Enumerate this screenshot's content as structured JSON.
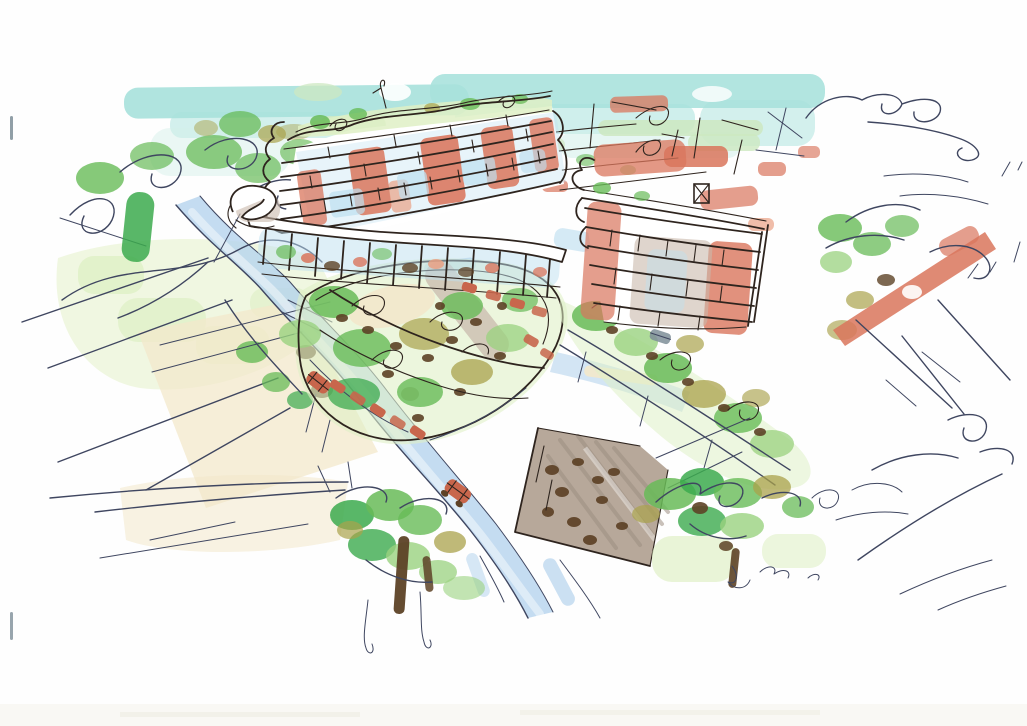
{
  "artwork": {
    "kind": "hand-drawn architectural concept sketch",
    "medium": "ink pen with marker and watercolor washes",
    "view": "aerial perspective of a mixed-use development",
    "visible_text": "",
    "description": "Aerial marker sketch of two curved terracotta apartment blocks over a retail podium, with a landscaped central garden with parked cars, light-blue access roads, a grey sloped plaza, street trees and a cyan sky band on white paper"
  },
  "palette": {
    "paper": "#fefefe",
    "sky": "#a7e1dc",
    "sky-light": "#d2efe9",
    "distant-green": "#cde8c1",
    "terracotta": "#d9755c",
    "terracotta-soft": "#e9a184",
    "glass": "#bedff0",
    "road": "#b5d3ed",
    "road-deep": "#8fb4da",
    "lawn": "#dff0c6",
    "lawn-pale": "#ecf5da",
    "green": "#68bb58",
    "green-bright": "#3caa4e",
    "green-soft": "#9ad27f",
    "olive": "#a9a24b",
    "olive-dark": "#8a7a30",
    "trunk": "#5d4226",
    "plaza": "#b7a89a",
    "plaza-dark": "#9d8e81",
    "concrete": "#c9b9ac",
    "cream": "#f3e8cb",
    "pen-dark": "#2e241e",
    "pen-blue": "#3f4660",
    "car-red": "#c8664c",
    "mark": "#7e8e98"
  },
  "scene": {
    "elements": [
      {
        "name": "sky-wash",
        "color": "sky"
      },
      {
        "name": "distant-buildings",
        "color": "terracotta"
      },
      {
        "name": "main-building",
        "color": "terracotta"
      },
      {
        "name": "east-building",
        "color": "terracotta"
      },
      {
        "name": "retail-podium",
        "color": "glass"
      },
      {
        "name": "spiral-ramp",
        "color": "concrete"
      },
      {
        "name": "access-road",
        "color": "road"
      },
      {
        "name": "central-garden-parking",
        "color": "green"
      },
      {
        "name": "right-garden-walk",
        "color": "green"
      },
      {
        "name": "gray-sloped-plaza",
        "color": "plaza"
      },
      {
        "name": "left-tree-cluster",
        "color": "green"
      },
      {
        "name": "bottom-tree-cluster",
        "color": "green-bright"
      },
      {
        "name": "bottom-right-tree-cluster",
        "color": "green"
      },
      {
        "name": "red-cars",
        "color": "car-red"
      },
      {
        "name": "scan-edge-marks",
        "color": "mark"
      }
    ]
  }
}
